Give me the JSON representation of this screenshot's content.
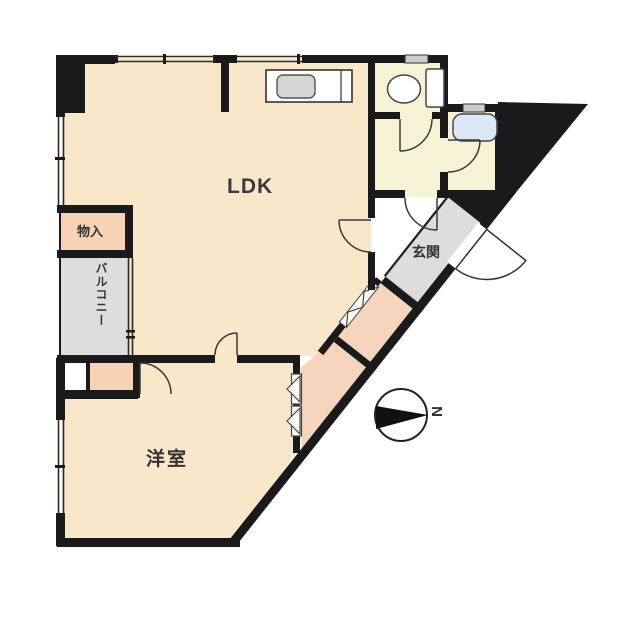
{
  "floorplan": {
    "rooms": {
      "ldk": {
        "label": "LDK"
      },
      "storage": {
        "label": "物入"
      },
      "balcony": {
        "label": "バルコニー"
      },
      "entrance": {
        "label": "玄関"
      },
      "western_room": {
        "label": "洋室"
      }
    },
    "compass": {
      "north_label": "N"
    },
    "colors": {
      "wall": "#1a1a1a",
      "room_cream": "#f9e7ca",
      "room_pink": "#f8d2b5",
      "corridor_pink": "#f7d4bc",
      "room_gray": "#dddddd",
      "room_pale_yellow": "#f6f2d6",
      "bathtub_blue": "#d9eaf6",
      "background": "#ffffff"
    }
  }
}
